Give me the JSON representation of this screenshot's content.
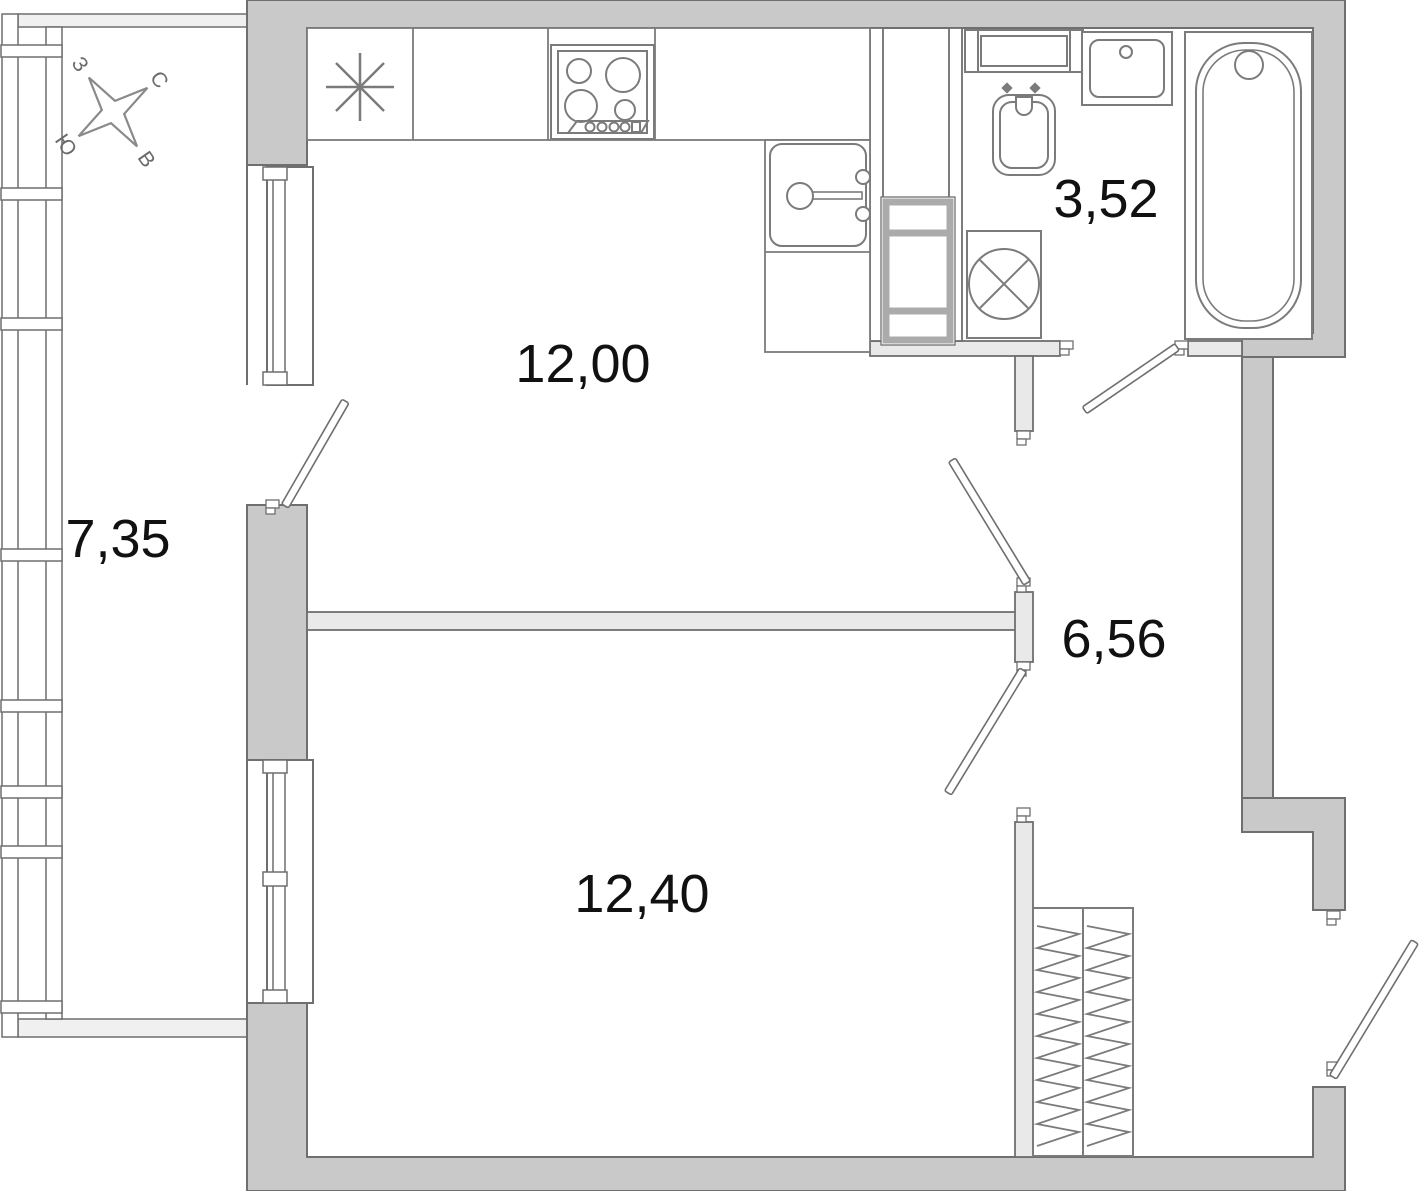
{
  "plan": {
    "rooms": [
      {
        "id": "balcony",
        "area_label": "7,35"
      },
      {
        "id": "kitchen",
        "area_label": "12,00"
      },
      {
        "id": "bathroom",
        "area_label": "3,52"
      },
      {
        "id": "hallway",
        "area_label": "6,56"
      },
      {
        "id": "living-room",
        "area_label": "12,40"
      }
    ],
    "compass": {
      "north_label": "С",
      "south_label": "Ю",
      "west_label": "З",
      "east_label": "В"
    },
    "colors": {
      "background": "#ffffff",
      "wall_fill": "#c9c9c9",
      "wall_stroke": "#6f6f6f",
      "partition_fill": "#e9e9e9",
      "balcony_sill_fill": "#f0f0f0",
      "fixture_stroke": "#7b7b7b",
      "shaft_stroke": "#ababab",
      "label_color": "#111111",
      "compass_color": "#6a6a6a"
    }
  }
}
